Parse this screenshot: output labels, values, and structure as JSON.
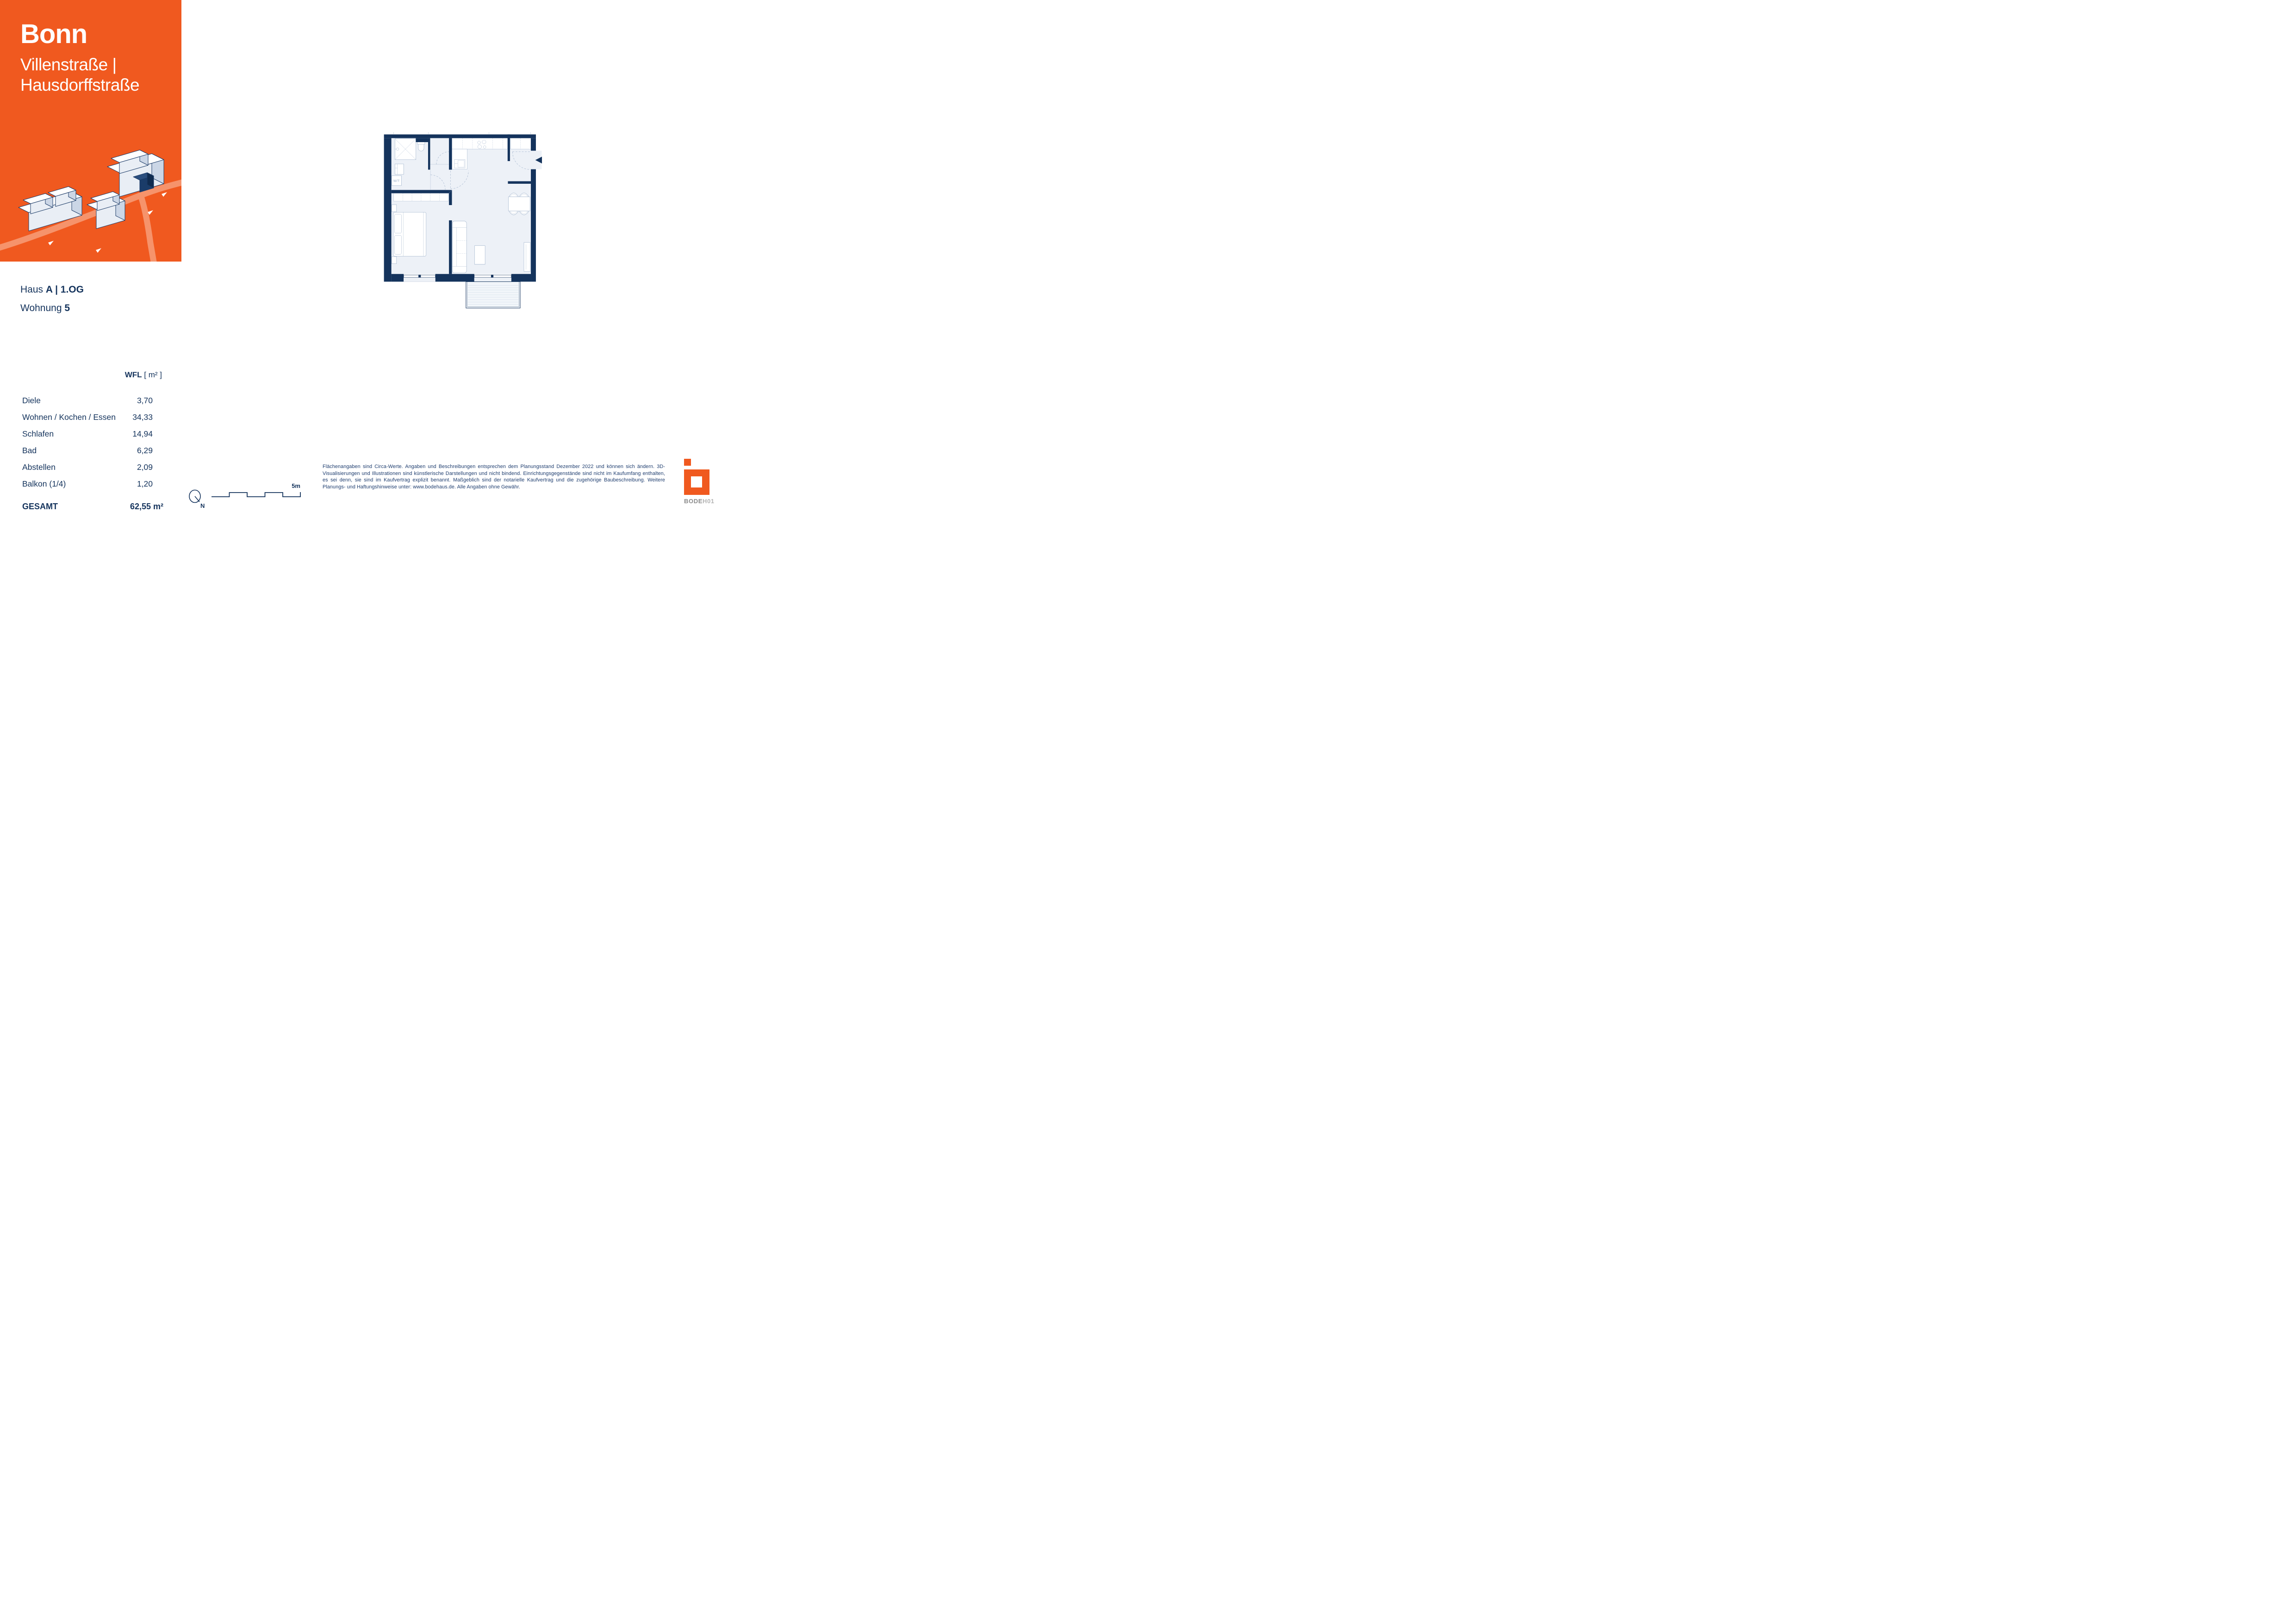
{
  "brand": {
    "city": "Bonn",
    "street_line1": "Villenstraße |",
    "street_line2": "Hausdorffstraße",
    "orange": "#F0591F",
    "street_color": "#F6936B"
  },
  "unit": {
    "haus_label": "Haus ",
    "haus_value": "A | 1.OG",
    "wohnung_label": "Wohnung ",
    "wohnung_value": "5"
  },
  "areas": {
    "header_label": "WFL",
    "header_unit": " [ m² ]",
    "rows": [
      {
        "label": "Diele",
        "value": "3,70"
      },
      {
        "label": "Wohnen / Kochen / Essen",
        "value": "34,33"
      },
      {
        "label": "Schlafen",
        "value": "14,94"
      },
      {
        "label": "Bad",
        "value": "6,29"
      },
      {
        "label": "Abstellen",
        "value": "2,09"
      },
      {
        "label": "Balkon (1/4)",
        "value": "1,20"
      }
    ],
    "total_label": "GESAMT",
    "total_value": "62,55 m²"
  },
  "floor_plan": {
    "wt_label": "W/T",
    "north_label": "N",
    "scale_label": "5m",
    "wall_color": "#14335C",
    "room_fill": "#EDF1F7",
    "furniture_stroke": "#9BAFC9"
  },
  "disclaimer": "Flächenangaben sind Circa-Werte. Angaben und Beschreibungen entsprechen dem Planungsstand Dezember 2022 und können sich ändern. 3D-Visualisierungen und Illustrationen sind künstlerische Darstellungen und nicht bindend. Einrichtungsgegenstände sind nicht im Kaufumfang enthalten, es sei denn, sie sind im Kaufvertrag explizit benannt. Maßgeblich sind der notarielle Kaufvertrag und die zugehörige Baubeschreibung. Weitere Planungs- und Haftungshinweise unter: www.bodehaus.de. Alle Angaben ohne Gewähr.",
  "logo": {
    "bode": "BODE",
    "h01": "H01"
  }
}
